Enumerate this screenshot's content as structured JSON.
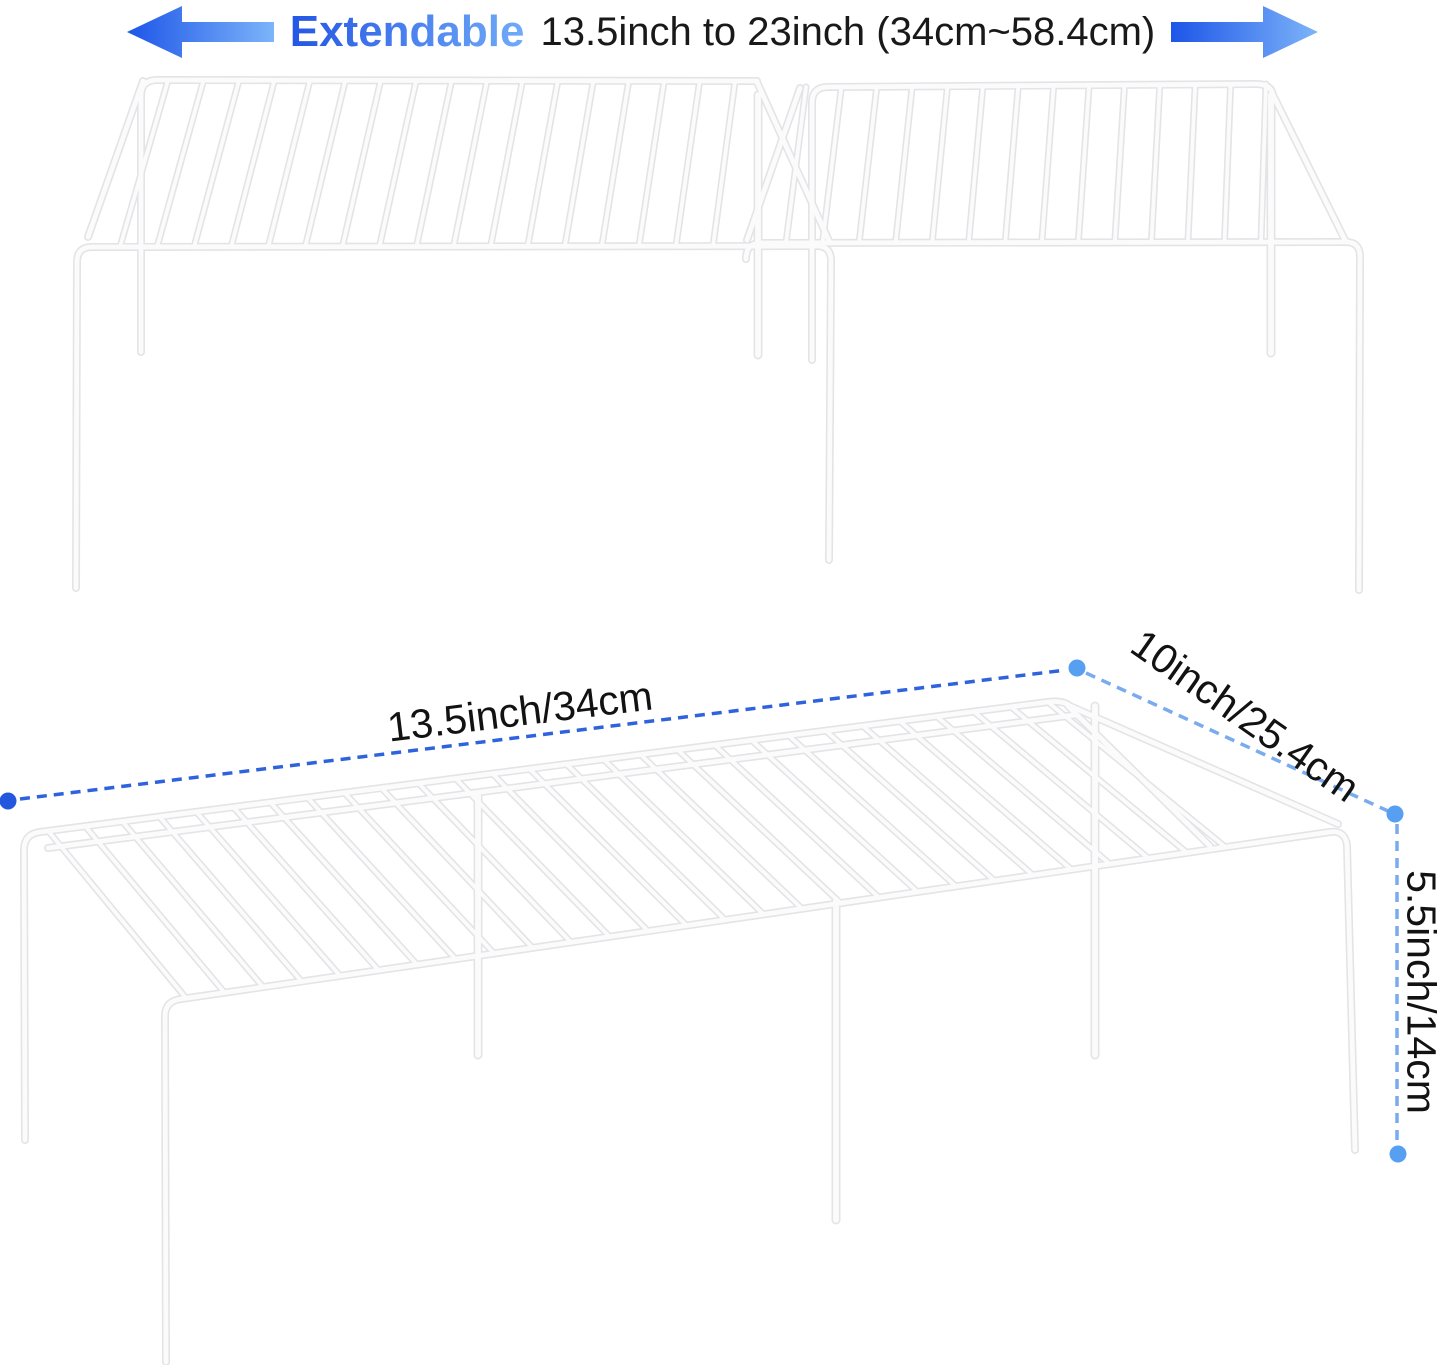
{
  "header": {
    "extendable_label": "Extendable",
    "size_text": "13.5inch to 23inch (34cm~58.4cm)"
  },
  "dimensions": {
    "width_label": "13.5inch/34cm",
    "depth_label": "10inch/25.4cm",
    "height_label": "5.5inch/14cm"
  },
  "icons": {
    "left_arrow": "left-arrow-icon",
    "right_arrow": "right-arrow-icon"
  },
  "colors": {
    "arrow_gradient_dark": "#1d55e8",
    "arrow_gradient_light": "#7db4f9",
    "extendable_gradient_dark": "#2456e4",
    "extendable_gradient_light": "#6fabf8",
    "header_text": "#191919",
    "dash_primary_blue": "#2e63dd",
    "dash_secondary_blue": "#79abee",
    "dot_primary_blue": "#2457dd",
    "dot_secondary_blue": "#57a0f1",
    "wire_outline": "#e4e4e7",
    "wire_core": "#fbfbfc",
    "background": "#ffffff"
  }
}
